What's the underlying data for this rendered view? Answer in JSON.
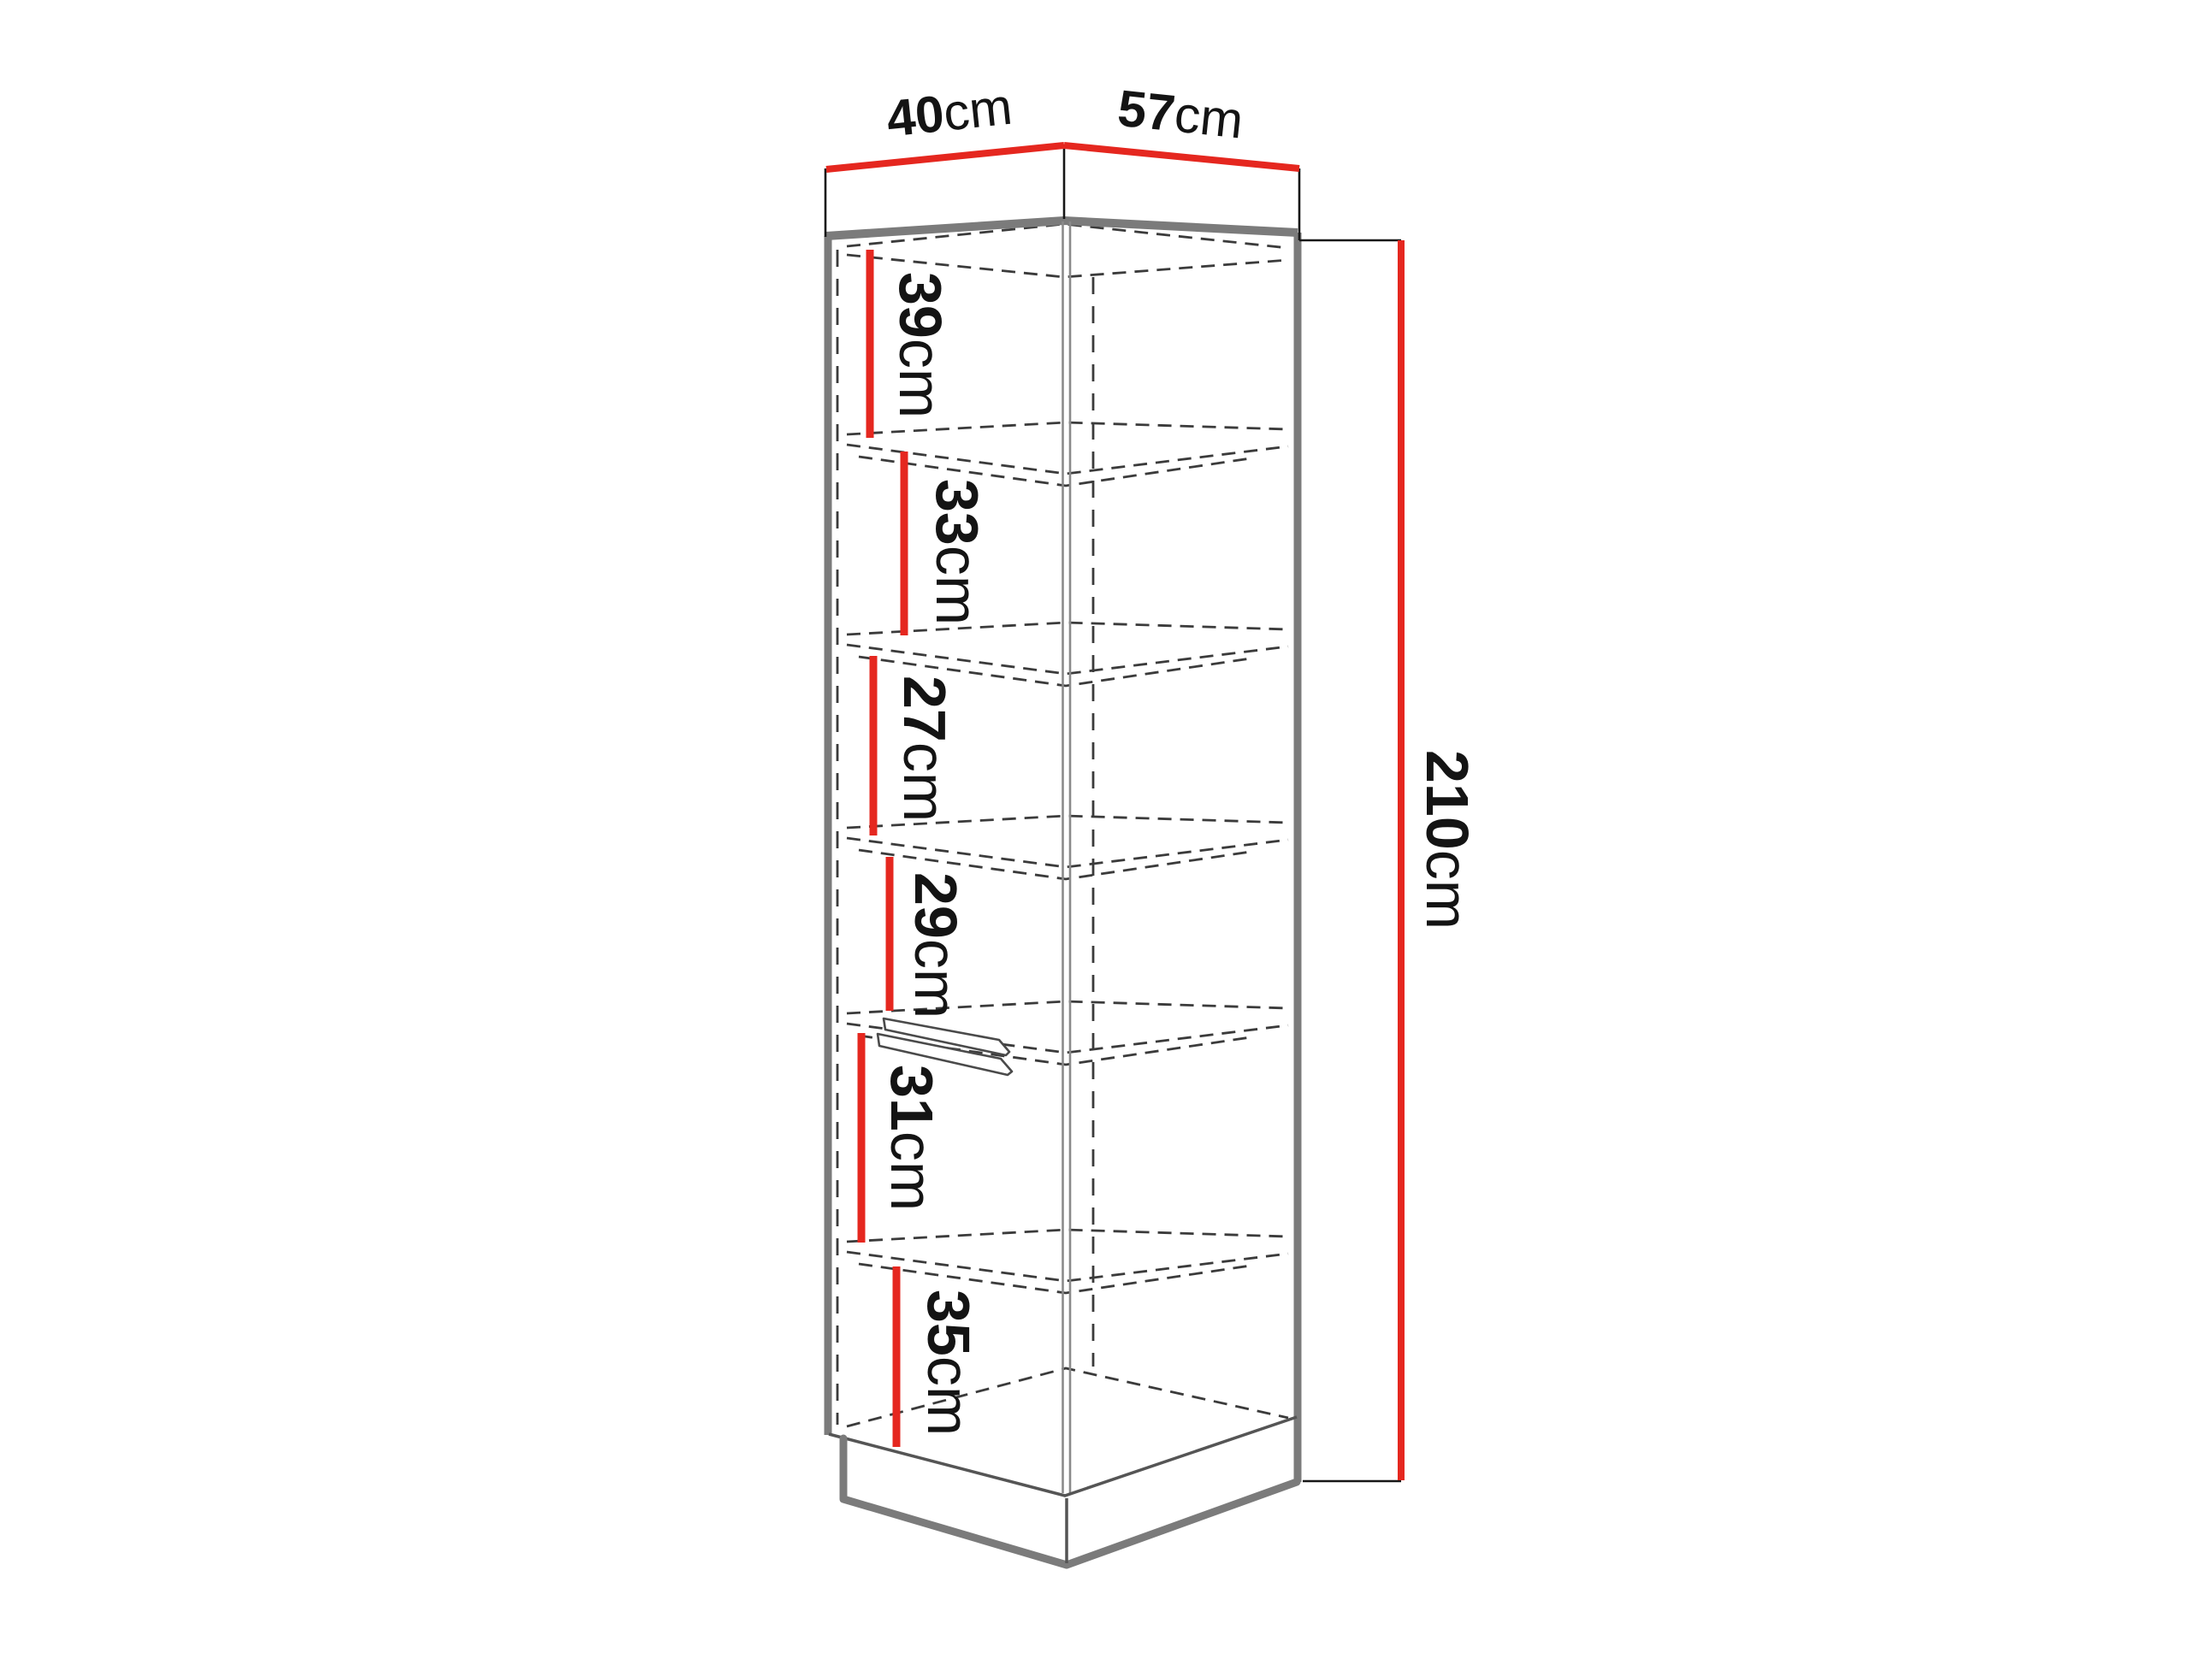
{
  "diagram": {
    "type": "furniture-dimension-diagram",
    "subject": "corner tall cabinet with shelves",
    "unit": "cm",
    "top_width_left": {
      "value": "40",
      "unit": "cm"
    },
    "top_width_right": {
      "value": "57",
      "unit": "cm"
    },
    "total_height": {
      "value": "210",
      "unit": "cm"
    },
    "shelf_heights": [
      {
        "value": "39",
        "unit": "cm"
      },
      {
        "value": "33",
        "unit": "cm"
      },
      {
        "value": "27",
        "unit": "cm"
      },
      {
        "value": "29",
        "unit": "cm"
      },
      {
        "value": "31",
        "unit": "cm"
      },
      {
        "value": "35",
        "unit": "cm"
      }
    ],
    "colors": {
      "dimension_red": "#e5271f",
      "outline_gray": "#7b7b7b",
      "dashed_gray": "#3b3b3b",
      "text_black": "#141414",
      "background": "#ffffff"
    }
  }
}
